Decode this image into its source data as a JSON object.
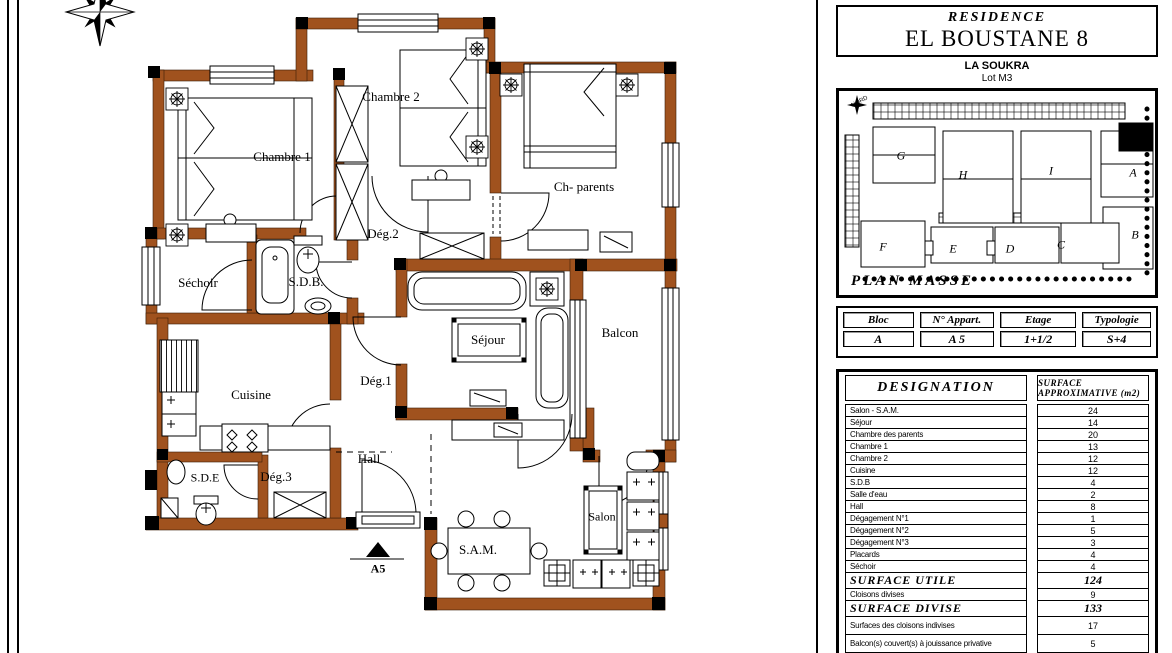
{
  "floor_plan": {
    "wall_color": "#a0521e",
    "rooms": [
      {
        "id": "chambre1",
        "label": "Chambre 1"
      },
      {
        "id": "chambre2",
        "label": "Chambre 2"
      },
      {
        "id": "ch_parents",
        "label": "Ch- parents"
      },
      {
        "id": "deg2",
        "label": "Dég.2"
      },
      {
        "id": "sechoir",
        "label": "Séchoir"
      },
      {
        "id": "sdb",
        "label": "S.D.B."
      },
      {
        "id": "cuisine",
        "label": "Cuisine"
      },
      {
        "id": "deg1",
        "label": "Dég.1"
      },
      {
        "id": "sejour",
        "label": "Séjour"
      },
      {
        "id": "balcon",
        "label": "Balcon"
      },
      {
        "id": "sde",
        "label": "S.D.E"
      },
      {
        "id": "deg3",
        "label": "Dég.3"
      },
      {
        "id": "hall",
        "label": "Hall"
      },
      {
        "id": "sam",
        "label": "S.A.M."
      },
      {
        "id": "salon",
        "label": "Salon"
      }
    ],
    "entrance_label": "A5"
  },
  "panel": {
    "title_small": "RESIDENCE",
    "title_main": "EL BOUSTANE 8",
    "location": "LA SOUKRA",
    "lot": "Lot M3",
    "plan_masse": {
      "title": "PLAN MASSE",
      "north": "NORD",
      "blocks": [
        "G",
        "H",
        "I",
        "A",
        "B",
        "F",
        "E",
        "D",
        "C"
      ],
      "highlighted_block": "A"
    },
    "apartment": {
      "headers": [
        "Bloc",
        "N° Appart.",
        "Etage",
        "Typologie"
      ],
      "values": [
        "A",
        "A 5",
        "1+1/2",
        "S+4"
      ]
    },
    "designation": {
      "header_left": "DESIGNATION",
      "header_right": "SURFACE APPROXIMATIVE (m2)",
      "rows": [
        {
          "label": "Salon - S.A.M.",
          "value": "24",
          "type": "normal"
        },
        {
          "label": "Séjour",
          "value": "14",
          "type": "normal"
        },
        {
          "label": "Chambre des parents",
          "value": "20",
          "type": "normal"
        },
        {
          "label": "Chambre 1",
          "value": "13",
          "type": "normal"
        },
        {
          "label": "Chambre 2",
          "value": "12",
          "type": "normal"
        },
        {
          "label": "Cuisine",
          "value": "12",
          "type": "normal"
        },
        {
          "label": "S.D.B",
          "value": "4",
          "type": "normal"
        },
        {
          "label": "Salle d'eau",
          "value": "2",
          "type": "normal"
        },
        {
          "label": "Hall",
          "value": "8",
          "type": "normal"
        },
        {
          "label": "Dégagement N°1",
          "value": "1",
          "type": "normal"
        },
        {
          "label": "Dégagement N°2",
          "value": "5",
          "type": "normal"
        },
        {
          "label": "Dégagement N°3",
          "value": "3",
          "type": "normal"
        },
        {
          "label": "Placards",
          "value": "4",
          "type": "normal"
        },
        {
          "label": "Séchoir",
          "value": "4",
          "type": "normal"
        },
        {
          "label": "SURFACE UTILE",
          "value": "124",
          "type": "total"
        },
        {
          "label": "Cloisons divises",
          "value": "9",
          "type": "normal"
        },
        {
          "label": "SURFACE DIVISE",
          "value": "133",
          "type": "total"
        },
        {
          "label": "Surfaces des cloisons indivises",
          "value": "17",
          "type": "tall"
        },
        {
          "label": "Balcon(s) couvert(s) à jouissance privative",
          "value": "5",
          "type": "tall"
        }
      ]
    }
  }
}
